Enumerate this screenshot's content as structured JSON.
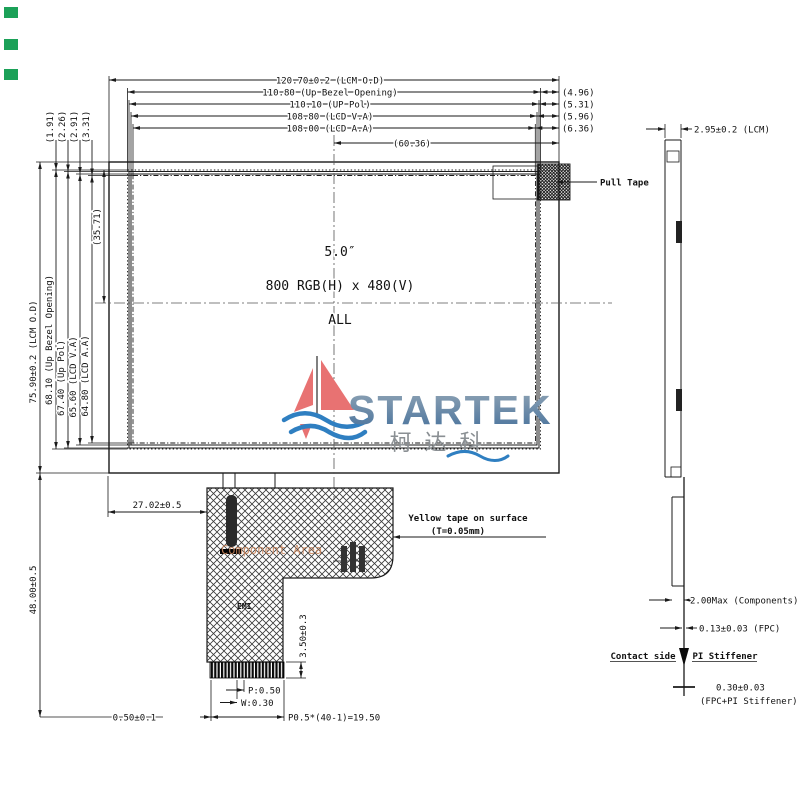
{
  "front_view": {
    "top_dims": [
      "120.70±0.2 (LCM O.D)",
      "110.80 (Up Bezel Opening)",
      "110.10 (UP Pol)",
      "108.80 (LCD V.A)",
      "108.00 (LCD A.A)"
    ],
    "half_width": "(60.36)",
    "right_gaps": [
      "(4.96)",
      "(5.31)",
      "(5.96)",
      "(6.36)"
    ],
    "left_dims": [
      "75.90±0.2 (LCM O.D)",
      "68.10 (Up Bezel Opening)",
      "67.40 (Up Pol)",
      "65.60 (LCD V.A)",
      "64.80 (LCD A.A)"
    ],
    "half_height": "(35.71)",
    "top_gaps": [
      "(1.91)",
      "(2.26)",
      "(2.91)",
      "(3.31)"
    ],
    "panel_size": "5.0″",
    "resolution": "800 RGB(H) x 480(V)",
    "mode": "ALL",
    "pull_tape_label": "Pull Tape",
    "yellow_tape_line1": "Yellow tape on surface",
    "yellow_tape_line2": "(T=0.05mm)",
    "component_area_label": "Component Area",
    "emi_label": "EMI",
    "fpc_offset": "27.02±0.5",
    "fpc_length": "48.00±0.5",
    "contact_height": "3.50±0.3",
    "pitch": "P:0.50",
    "finger_width": "W:0.30",
    "edge_margin": "0.50±0.1",
    "pitch_total": "P0.5*(40-1)=19.50"
  },
  "side_view": {
    "thickness": "2.95±0.2 (LCM)",
    "components_max": "2.00Max (Components)",
    "fpc_thickness": "0.13±0.03 (FPC)",
    "contact_side": "Contact side",
    "pi_stiffener": "PI Stiffener",
    "stiffener_total": "0.30±0.03",
    "stiffener_total2": "(FPC+PI Stiffener)"
  },
  "logo": {
    "name": "STARTEK",
    "chinese": "柯达科"
  },
  "colors": {
    "line": "#1a1a1a",
    "logo_blue_top": "#93a6b6",
    "logo_blue_bottom": "#46719c",
    "logo_red": "#e87272",
    "wave_blue": "#2f7fc1",
    "component_area_text": "#c9855c",
    "marker_green": "#1ba158"
  }
}
